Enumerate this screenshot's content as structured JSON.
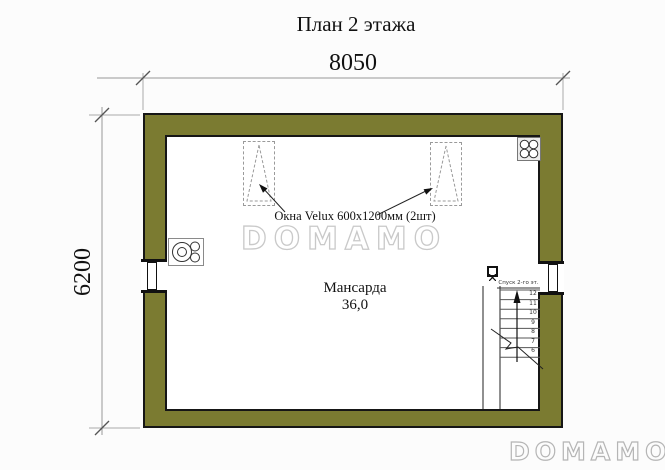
{
  "title": "План 2 этажа",
  "dimensions": {
    "top": "8050",
    "left": "6200"
  },
  "room": {
    "name": "Мансарда",
    "area": "36,0"
  },
  "notes": {
    "velux": "Окна Velux 600х1200мм (2шт)",
    "stairs": "Спуск 2-го эт."
  },
  "stairs": {
    "step_numbers": [
      "12",
      "11",
      "10",
      "9",
      "8",
      "7",
      "6"
    ]
  },
  "watermarks": {
    "center": "DOMAMO",
    "corner": "DOMAMO"
  },
  "colors": {
    "wall_fill": "#7b7b31",
    "wall_outline": "#161616",
    "dim_line": "#999999",
    "watermark_outline": "#c9c9c9"
  }
}
